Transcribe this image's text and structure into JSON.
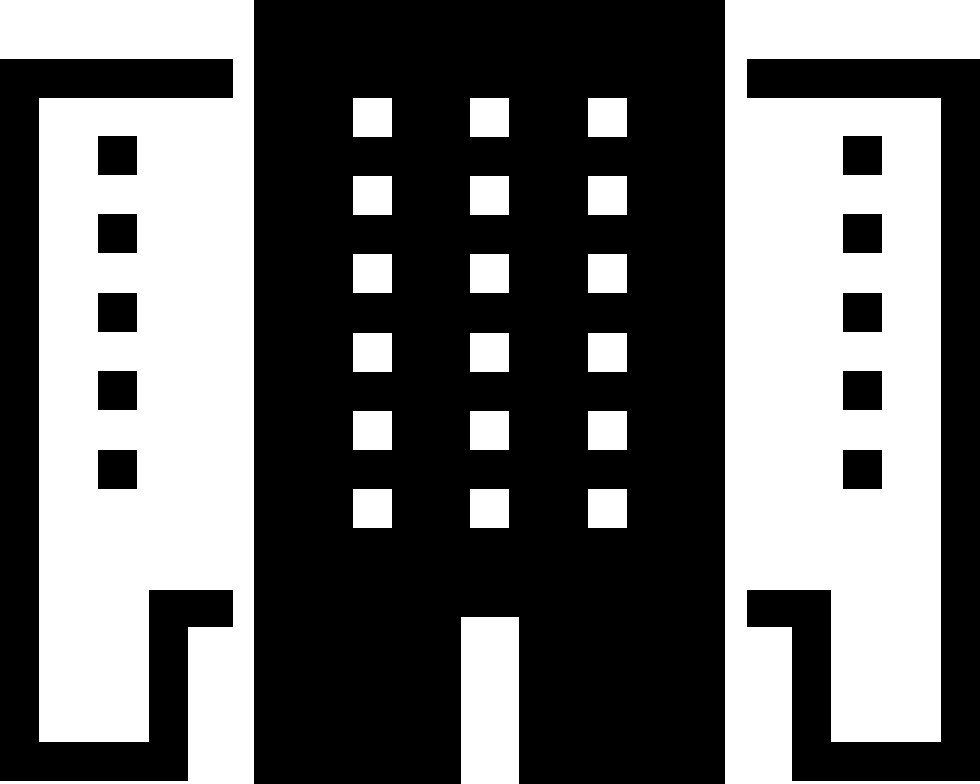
{
  "icon": {
    "name": "city-buildings",
    "description": "Monochrome glyph of three buildings: a solid black central tower with a 3x6 grid of white windows and a white entrance door at the bottom, flanked by two white outlined side buildings, each with a black roof bar, outer wall, stepped entrance notch at the base, and a single column of five black windows",
    "colors": {
      "foreground": "#000000",
      "background": "#ffffff"
    },
    "buildings": {
      "center": {
        "window_rows": 6,
        "window_cols": 3,
        "has_door": true
      },
      "left": {
        "window_rows": 5,
        "window_cols": 1,
        "has_door": false
      },
      "right": {
        "window_rows": 5,
        "window_cols": 1,
        "has_door": false
      }
    }
  }
}
